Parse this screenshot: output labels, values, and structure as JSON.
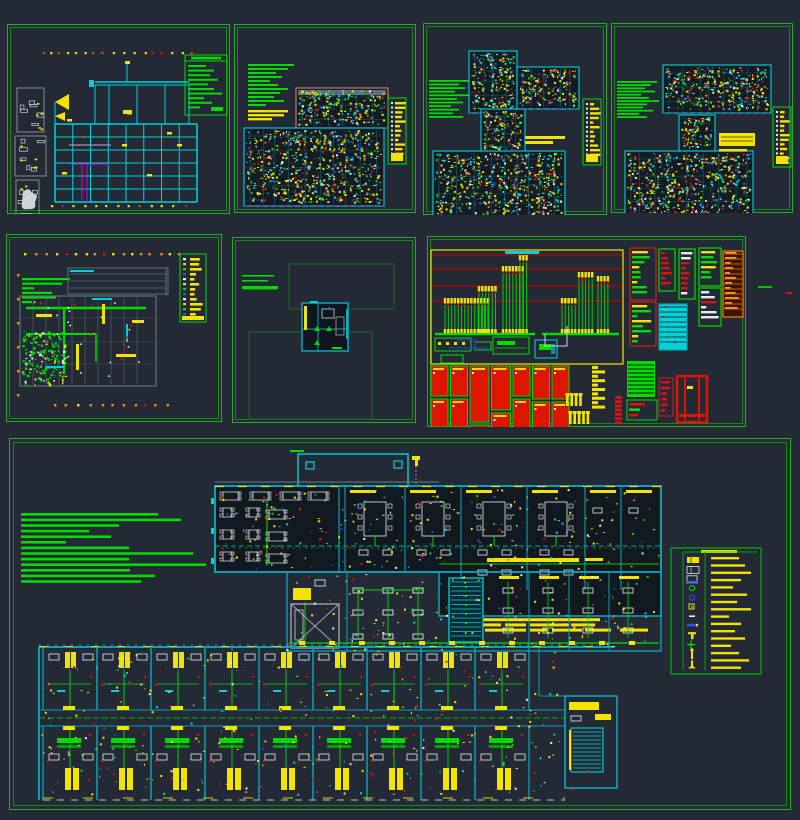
{
  "canvas": {
    "width": 800,
    "height": 820,
    "background": "#232a35"
  },
  "colors": {
    "bg": "#232a35",
    "dkroom": "#141b24",
    "frame_outer": "#22ae22",
    "frame_inner": "#148a14",
    "green": "#00dc00",
    "green_dim": "#00a000",
    "yellow": "#f2e400",
    "orange_tick": "#ff8c00",
    "cyan": "#00d2dc",
    "teal": "#0b8696",
    "teal_wall": "#0ba0b4",
    "gray_wall": "#5d7078",
    "lt_gray": "#cfd4d8",
    "white": "#e8ecef",
    "red": "#e01010",
    "red_fill": "#dc1400",
    "orange": "#ff7a00",
    "blue": "#2244ee",
    "magenta": "#d800d8",
    "rose": "#cc8484",
    "vgreen": "#1d5c2a",
    "gray_line": "#6d7a84",
    "lavender": "#b8a8d8"
  },
  "sheets": [
    {
      "name": "structural-grid-plan",
      "type": "grid",
      "x": 7,
      "y": 24,
      "w": 223,
      "h": 190,
      "seed": 3,
      "grid": {
        "x": 48,
        "y": 100,
        "w": 142,
        "h": 78,
        "cols": 8,
        "rows": 6
      },
      "upper": {
        "x": 88,
        "y": 58,
        "w": 94,
        "h": 42
      },
      "axis_ticks": {
        "top_y": 28,
        "bottom_y": 181,
        "x0": 36,
        "x1": 188
      },
      "legend": {
        "x": 178,
        "y": 31,
        "w": 42,
        "h": 60,
        "bars": [
          18,
          26,
          22,
          30,
          20,
          26,
          34,
          16,
          24,
          12
        ]
      }
    },
    {
      "name": "dense-floor-plan-1",
      "type": "dense",
      "x": 234,
      "y": 24,
      "w": 182,
      "h": 189,
      "seed": 11,
      "notes": {
        "x": 14,
        "y": 40,
        "step": 4,
        "h": 2,
        "color": "green",
        "widths": [
          46,
          40,
          28,
          34,
          22,
          30,
          40,
          32,
          26,
          36,
          18
        ]
      },
      "notes2": {
        "x": 14,
        "y": 86,
        "step": 4,
        "h": 2.4,
        "color": "yellow",
        "widths": [
          40,
          36,
          24
        ]
      },
      "blocks": [
        {
          "x": 62,
          "y": 64,
          "w": 92,
          "h": 40,
          "edge": "rose",
          "band": true
        },
        {
          "x": 10,
          "y": 104,
          "w": 140,
          "h": 78,
          "edge": "cyan"
        }
      ],
      "legend": {
        "x": 154,
        "y": 74,
        "w": 18,
        "h": 66
      }
    },
    {
      "name": "dense-floor-plan-2",
      "type": "dense",
      "x": 423,
      "y": 23,
      "w": 184,
      "h": 192,
      "seed": 23,
      "notes": {
        "x": 6,
        "y": 57,
        "step": 3.6,
        "h": 1.8,
        "color": "green",
        "widths": [
          42,
          30,
          36,
          26,
          40,
          28,
          34,
          22,
          30,
          24,
          34
        ]
      },
      "notes2": {
        "x": 100,
        "y": 113,
        "step": 5,
        "h": 3,
        "color": "yellow",
        "widths": [
          42,
          30
        ]
      },
      "blocks": [
        {
          "x": 46,
          "y": 28,
          "w": 48,
          "h": 62,
          "edge": "cyan"
        },
        {
          "x": 94,
          "y": 44,
          "w": 62,
          "h": 42,
          "edge": "cyan"
        },
        {
          "x": 58,
          "y": 86,
          "w": 44,
          "h": 44,
          "edge": "cyan"
        },
        {
          "x": 10,
          "y": 128,
          "w": 132,
          "h": 74,
          "edge": "cyan"
        }
      ],
      "legend": {
        "x": 160,
        "y": 76,
        "w": 18,
        "h": 66
      }
    },
    {
      "name": "dense-floor-plan-3",
      "type": "dense",
      "x": 611,
      "y": 23,
      "w": 182,
      "h": 190,
      "seed": 37,
      "notes": {
        "x": 6,
        "y": 58,
        "step": 3.2,
        "h": 1.8,
        "color": "green",
        "widths": [
          40,
          34,
          28,
          38,
          24,
          32,
          42,
          30,
          26,
          36,
          22,
          30
        ]
      },
      "blocks": [
        {
          "x": 52,
          "y": 42,
          "w": 108,
          "h": 48,
          "edge": "cyan"
        },
        {
          "x": 68,
          "y": 92,
          "w": 36,
          "h": 36,
          "edge": "cyan"
        },
        {
          "x": 14,
          "y": 128,
          "w": 128,
          "h": 78,
          "edge": "cyan"
        }
      ],
      "yellow_block": {
        "x": 108,
        "y": 110,
        "w": 36,
        "h": 13
      },
      "legend": {
        "x": 162,
        "y": 84,
        "w": 18,
        "h": 60
      }
    },
    {
      "name": "equipment-floor-plan",
      "type": "equip",
      "x": 6,
      "y": 234,
      "w": 216,
      "h": 188,
      "seed": 5,
      "notes": {
        "x": 16,
        "y": 44,
        "step": 4.6,
        "h": 2.2,
        "color": "green",
        "widths": [
          48,
          40,
          12,
          30,
          34,
          10
        ]
      },
      "legend": {
        "x": 174,
        "y": 20,
        "w": 26,
        "h": 68
      },
      "plan": {
        "x": 14,
        "y": 62,
        "w": 136,
        "h": 90,
        "upper": {
          "x": 62,
          "y": 34,
          "w": 100,
          "h": 26
        }
      }
    },
    {
      "name": "viewport-detail-sheet",
      "type": "viewports",
      "x": 232,
      "y": 237,
      "w": 184,
      "h": 186,
      "seed": 8,
      "notes": {
        "x": 10,
        "y": 38,
        "step": 5,
        "h": 1.6,
        "color": "green",
        "widths": [
          32,
          26
        ]
      },
      "note_thick": {
        "x": 10,
        "y": 49,
        "w": 36,
        "h": 3.4
      },
      "viewports": [
        {
          "x": 57,
          "y": 27,
          "w": 105,
          "h": 45
        },
        {
          "x": 17,
          "y": 95,
          "w": 123,
          "h": 87
        }
      ],
      "detail": {
        "x": 70,
        "y": 66,
        "w": 46,
        "h": 48
      }
    },
    {
      "name": "power-distribution-diagram",
      "type": "schematic",
      "x": 427,
      "y": 236,
      "w": 319,
      "h": 191,
      "seed": 42,
      "riser_box": {
        "x": 4,
        "y": 14,
        "w": 192,
        "h": 114
      },
      "floor_lines_y": [
        19,
        33,
        50,
        65
      ],
      "bus_y": 98,
      "bus": [
        [
          8,
          108
        ],
        [
          115,
          192
        ]
      ],
      "risers": [
        {
          "x": 18,
          "n": 14,
          "top": 62
        },
        {
          "x": 52,
          "n": 6,
          "top": 50
        },
        {
          "x": 76,
          "n": 7,
          "top": 30
        },
        {
          "x": 93,
          "n": 3,
          "top": 19
        },
        {
          "x": 135,
          "n": 5,
          "top": 62
        },
        {
          "x": 152,
          "n": 5,
          "top": 36
        },
        {
          "x": 171,
          "n": 4,
          "top": 40
        }
      ],
      "red_grid": {
        "x0": 4,
        "gap": 2.5,
        "y": 130,
        "cols": [
          17,
          17,
          19,
          19,
          17,
          17,
          17
        ],
        "rows": [
          [
            30,
            28
          ],
          [
            30,
            28
          ],
          [
            56,
            24
          ],
          [
            44,
            16
          ],
          [
            30,
            40
          ],
          [
            33,
            29
          ],
          [
            33,
            29
          ]
        ]
      }
    },
    {
      "name": "composite-floor-plan",
      "type": "composite",
      "x": 9,
      "y": 438,
      "w": 782,
      "h": 372,
      "seed": 99,
      "notes": {
        "x": 12,
        "y": 75,
        "step": 5.6,
        "h": 2.6,
        "color": "green",
        "widths": [
          137,
          160,
          98,
          68,
          90,
          45,
          108,
          172,
          108,
          185,
          109,
          134,
          120
        ]
      },
      "yellow_notes": {
        "x": 441,
        "y": 175,
        "step": 5.2,
        "h": 3,
        "rows": [
          [
            [
              0,
              61
            ]
          ],
          [
            [
              0,
              150
            ]
          ],
          [
            [
              1,
              12
            ],
            [
              16,
              35
            ],
            [
              55,
              21
            ],
            [
              80,
              38
            ],
            [
              121,
              24
            ]
          ],
          [
            [
              1,
              8
            ],
            [
              12,
              20
            ],
            [
              35,
              41
            ],
            [
              80,
              18
            ],
            [
              102,
              30
            ],
            [
              135,
              26
            ],
            [
              170,
              28
            ]
          ]
        ]
      },
      "canopy": {
        "x": 289,
        "y": 16,
        "w": 110,
        "h": 34
      },
      "upper_wing": {
        "x": 206,
        "y": 48,
        "w": 446,
        "h": 86,
        "partitions": [
          336,
          396,
          452,
          518,
          576,
          612
        ],
        "corridor_y": 108
      },
      "core": {
        "x": 278,
        "y": 134,
        "w": 374,
        "h": 79
      },
      "lower_band": {
        "x": 30,
        "y": 208,
        "w": 526,
        "h": 155,
        "module_x0": 34,
        "module_w": 54,
        "modules": 9,
        "corridor": [
          272,
          288
        ]
      },
      "legend": {
        "x": 662,
        "y": 110,
        "w": 90,
        "h": 126,
        "icons": [
          "panel-yellow",
          "lamp-white",
          "lamp-white-blue",
          "circle-green",
          "circle-blue",
          "square-yellow",
          "dash-white",
          "bar-blue",
          "tee-yellow",
          "cross-green",
          "pole-yellow",
          "pole-yellow-base"
        ],
        "bar_widths": [
          28,
          34,
          40,
          30,
          22,
          36,
          26,
          40,
          18,
          30,
          24,
          34,
          20,
          28,
          38,
          30
        ]
      }
    }
  ],
  "strays": [
    {
      "x": 758,
      "y": 286,
      "w": 14,
      "h": 2,
      "color": "#00c000"
    },
    {
      "x": 786,
      "y": 292,
      "w": 6,
      "h": 2,
      "color": "#e01010"
    }
  ]
}
